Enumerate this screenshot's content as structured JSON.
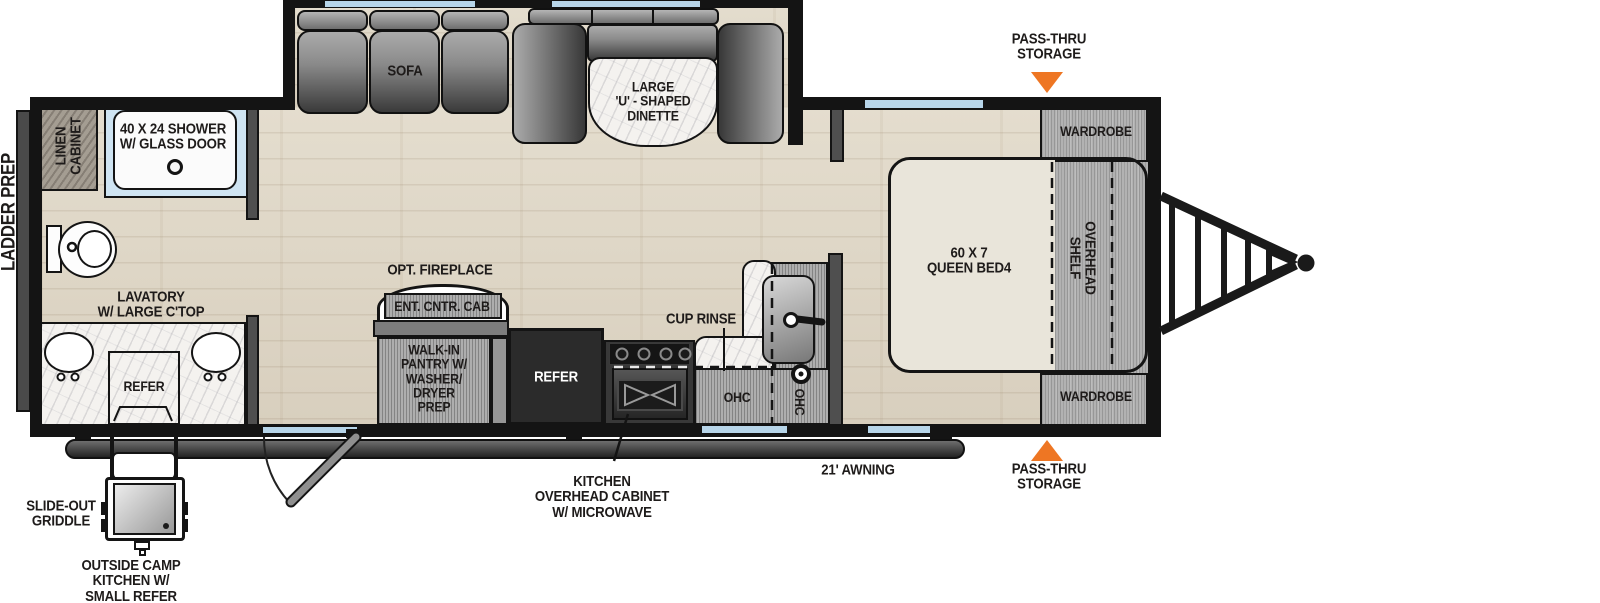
{
  "title": "Travel trailer floor plan",
  "labels": {
    "ladder_prep": "LADDER PREP",
    "linen_cabinet": "LINEN\nCABINET",
    "shower": "40 X 24 SHOWER\nW/ GLASS DOOR",
    "lavatory": "LAVATORY\nW/ LARGE C'TOP",
    "outside_refer": "REFER",
    "slide_out_griddle": "SLIDE-OUT\nGRIDDLE",
    "outside_camp_kitchen": "OUTSIDE CAMP\nKITCHEN W/\nSMALL REFER",
    "sofa": "SOFA",
    "dinette": "LARGE\n'U' - SHAPED\nDINETTE",
    "opt_fireplace": "OPT. FIREPLACE",
    "ent_cntr_cab": "ENT. CNTR. CAB",
    "pantry": "WALK-IN\nPANTRY W/\nWASHER/\nDRYER\nPREP",
    "main_refer": "REFER",
    "cup_rinse": "CUP RINSE",
    "ohc_main": "OHC",
    "ohc_side": "OHC",
    "kitchen_ohc": "KITCHEN\nOVERHEAD CABINET\nW/ MICROWAVE",
    "awning": "21' AWNING",
    "pass_thru_top": "PASS-THRU\nSTORAGE",
    "pass_thru_bottom": "PASS-THRU\nSTORAGE",
    "wardrobe_top": "WARDROBE",
    "wardrobe_bottom": "WARDROBE",
    "queen_bed": "60 X 7\nQUEEN BED4",
    "overhead_shelf": "OVERHEAD\nSHELF"
  },
  "colors": {
    "wall": "#141414",
    "floor_wood": "#ded6c6",
    "cabinet_gray": "#b2b2b2",
    "window_blue": "#b7d5e9",
    "accent_orange": "#ee7623",
    "bed_beige": "#e9e5da",
    "appliance_dark": "#2b2b2b"
  }
}
